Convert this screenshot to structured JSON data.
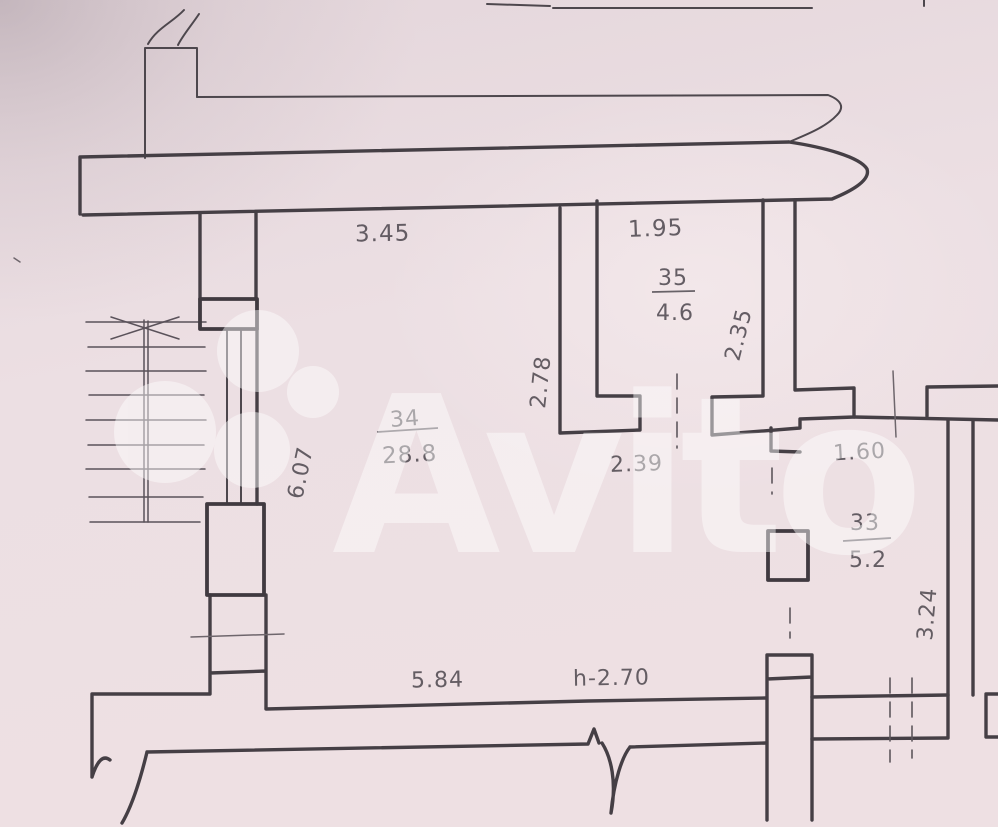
{
  "watermark": {
    "brand": "Avito"
  },
  "rooms": {
    "r34": {
      "number": "34",
      "area": "28.8"
    },
    "r35": {
      "number": "35",
      "area": "4.6"
    },
    "r33": {
      "number": "33",
      "area": "5.2"
    }
  },
  "dimensions": {
    "room34_top_width": "3.45",
    "room35_top_width": "1.95",
    "room35_right_height": "2.35",
    "room34_right_upper_height": "2.78",
    "room34_left_height": "6.07",
    "passage_width": "2.39",
    "room33_top_width": "1.60",
    "room33_right_height": "3.24",
    "room34_bottom_width": "5.84",
    "ceiling_height": "h-2.70"
  },
  "colors": {
    "paper": "#ecdfe3",
    "paper_shadow": "#d3c6cc",
    "ink": "#453f45",
    "label_ink": "#514b52",
    "watermark": "#ffffff"
  }
}
